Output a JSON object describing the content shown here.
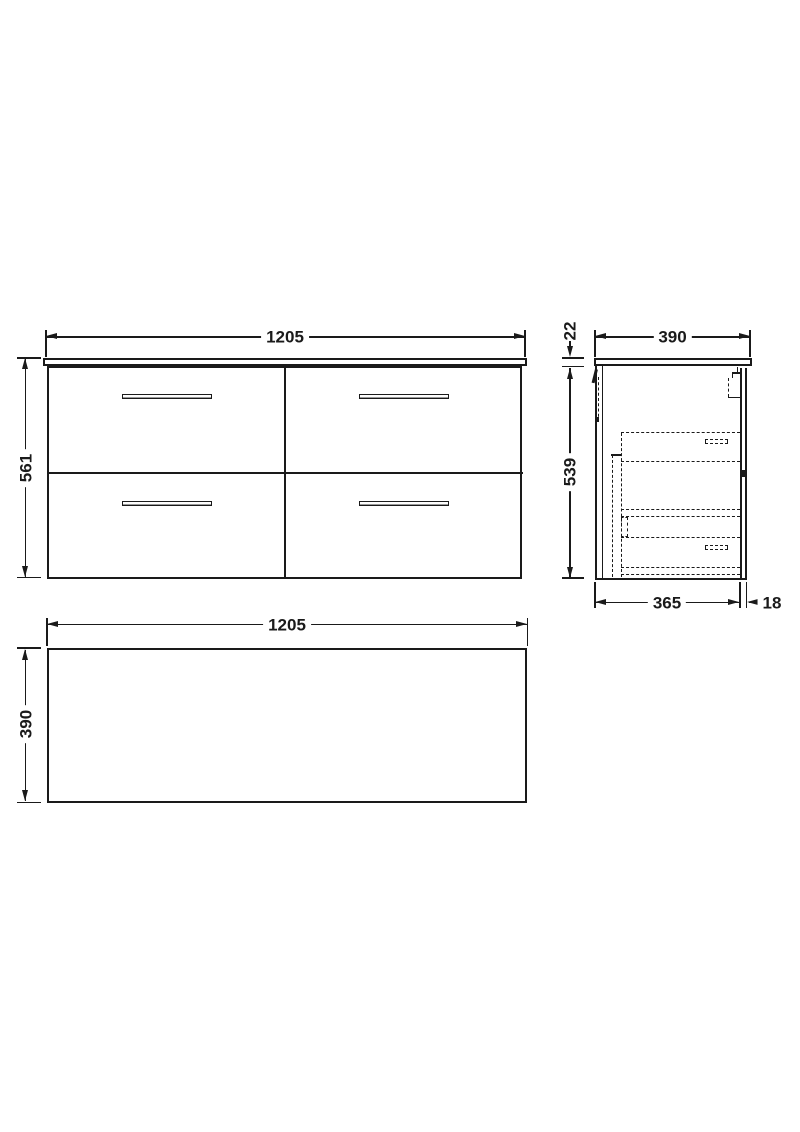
{
  "style": {
    "line_color": "#1a1a1a",
    "background_color": "#ffffff"
  },
  "drawing": {
    "front": {
      "width": "1205",
      "height": "561"
    },
    "side": {
      "depth": "390",
      "top_thickness": "22",
      "height": "539",
      "body_depth": "365",
      "back_offset": "18"
    },
    "plan": {
      "width": "1205",
      "depth": "390"
    }
  }
}
